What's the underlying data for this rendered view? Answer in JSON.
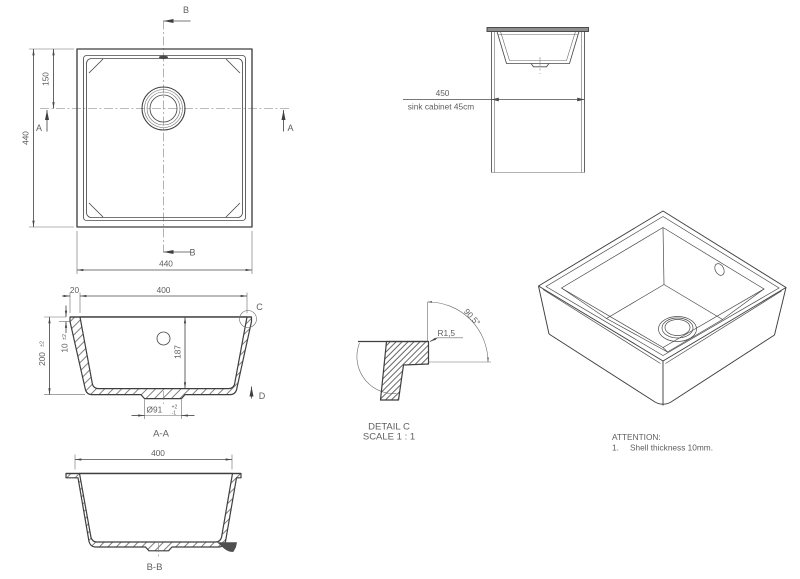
{
  "colors": {
    "line": "#3f3f3f",
    "text": "#5f5f5f",
    "countertop_fill": "#8f8f8f",
    "background": "#ffffff"
  },
  "top_view": {
    "section_marker_b_top": "B",
    "section_marker_b_bottom": "B",
    "section_marker_a_left": "A",
    "section_marker_a_right": "A",
    "dim_overall_height": "440",
    "dim_drain_center_from_top": "150",
    "dim_overall_width": "440"
  },
  "cabinet_view": {
    "dim_cabinet_width": "450",
    "note": "sink cabinet 45cm"
  },
  "section_aa": {
    "label": "A-A",
    "dim_rim_width": "20",
    "dim_bowl_width": "400",
    "dim_shell_thickness": "10",
    "dim_shell_tolerance": "±2",
    "dim_overall_depth": "200",
    "dim_depth_tolerance": "±2",
    "dim_inner_depth": "187",
    "dim_drain_diameter": "Ø91",
    "drain_tolerance_plus": "+2",
    "drain_tolerance_minus": "-1",
    "detail_marker": "C",
    "direction_marker": "D"
  },
  "detail_c": {
    "radius": "R1,5",
    "angle": "90.5°",
    "title": "DETAIL C",
    "scale": "SCALE 1 : 1"
  },
  "section_bb": {
    "label": "B-B",
    "dim_bowl_width": "400"
  },
  "attention": {
    "title": "ATTENTION:",
    "item_number": "1.",
    "item_text": "Shell thickness 10mm."
  }
}
